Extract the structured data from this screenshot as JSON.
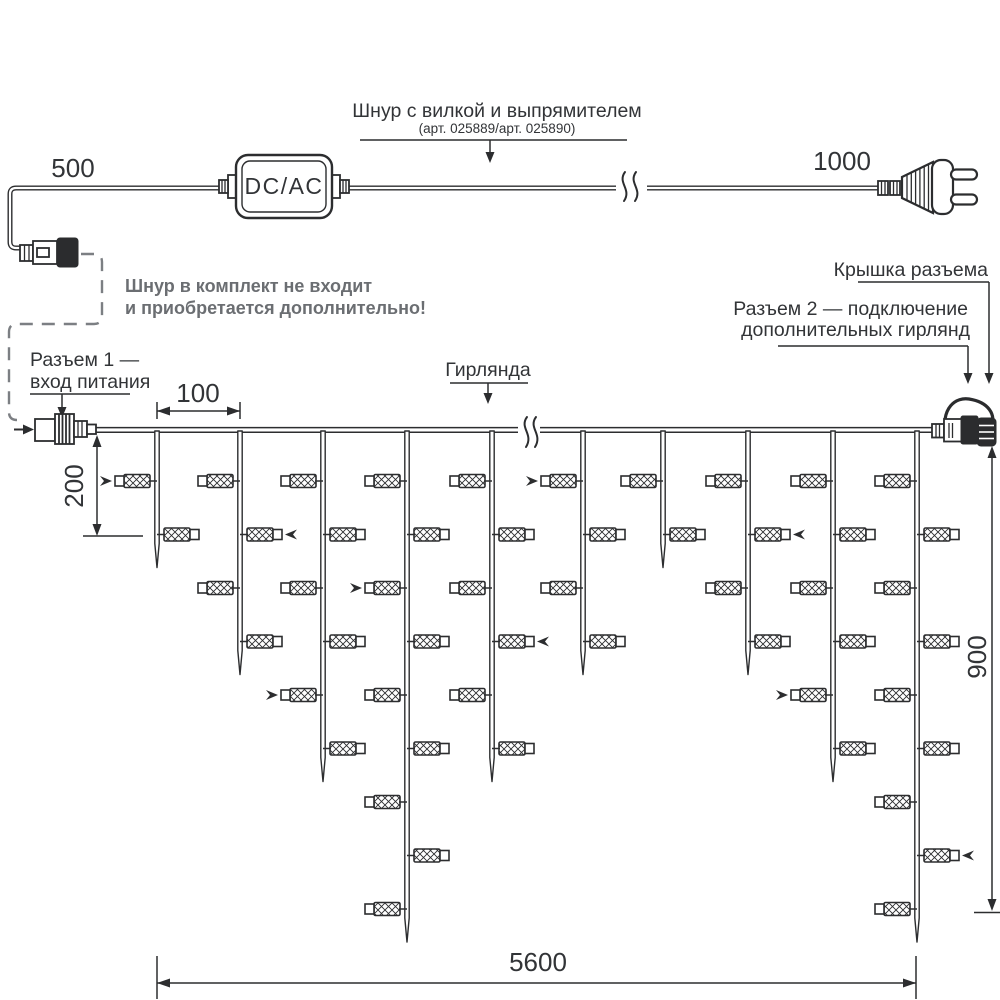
{
  "colors": {
    "line": "#2c2d2f",
    "note_text": "#6b6e72",
    "dashed_line": "#7c7f83",
    "label_text": "#323437"
  },
  "power_cord": {
    "label": "Шнур с вилкой и выпрямителем",
    "sublabel": "(арт. 025889/арт. 025890)",
    "converter_label": "DC/AC",
    "dim_left": "500",
    "dim_right": "1000"
  },
  "note": {
    "line1": "Шнур в комплект не входит",
    "line2": "и приобретается дополнительно!"
  },
  "labels": {
    "connector1_line1": "Разъем 1 —",
    "connector1_line2": "вход питания",
    "connector2_line1": "Разъем 2 — подключение",
    "connector2_line2": "дополнительных гирлянд",
    "cap": "Крышка разъема",
    "garland": "Гирлянда"
  },
  "dimensions": {
    "drop_spacing": "100",
    "first_drop": "200",
    "height": "900",
    "length": "5600"
  },
  "garland": {
    "drop_x": [
      157,
      240,
      323,
      407,
      492,
      583,
      663,
      748,
      833,
      917
    ],
    "lamp_counts": [
      2,
      4,
      6,
      9,
      6,
      4,
      2,
      4,
      6,
      9
    ],
    "wire_y": 431,
    "row_start_y": 481,
    "row_spacing": 53.5,
    "tip_extra": 33,
    "flash_markers": [
      [
        1,
        1
      ],
      [
        2,
        2
      ],
      [
        3,
        5
      ],
      [
        4,
        3
      ],
      [
        5,
        4
      ],
      [
        6,
        1
      ],
      [
        8,
        2
      ],
      [
        9,
        5
      ],
      [
        10,
        8
      ]
    ]
  }
}
